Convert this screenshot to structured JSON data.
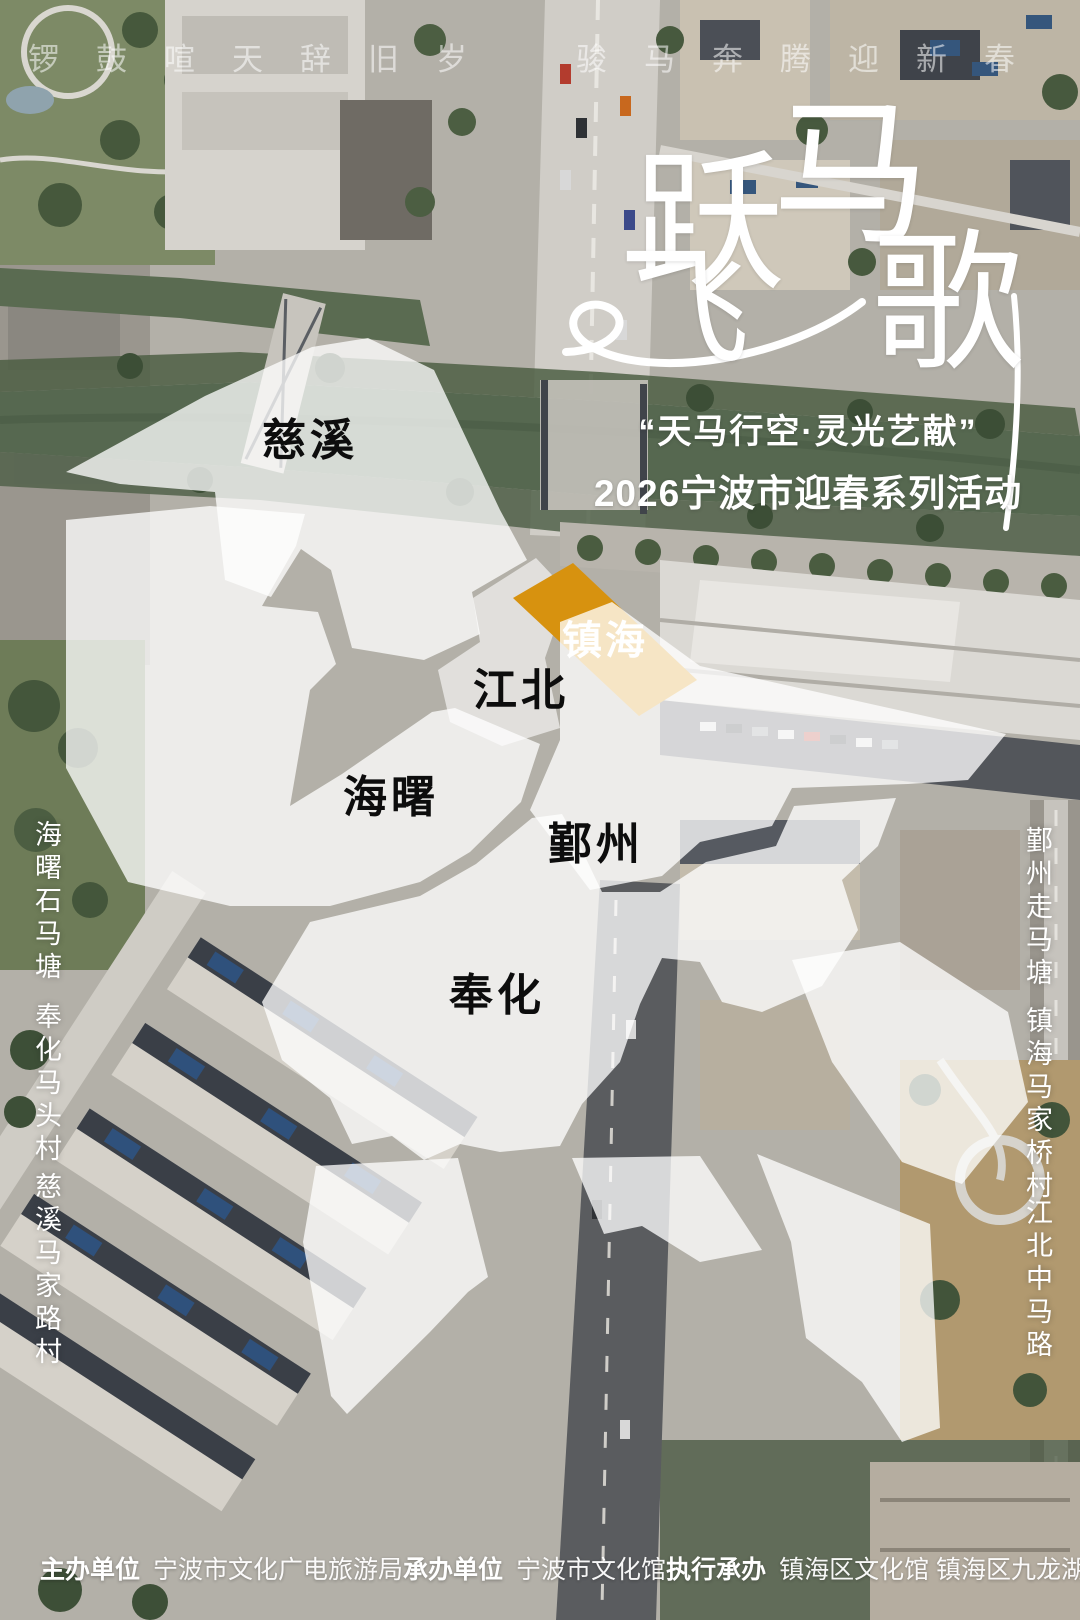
{
  "top_banner": {
    "left_phrase": "锣鼓喧天辞旧岁",
    "right_phrase": "骏马奔腾迎新春"
  },
  "title": {
    "text": "跃马飞歌",
    "chars": [
      "跃",
      "马",
      "飞",
      "歌"
    ]
  },
  "subtitle": {
    "line1": "“天马行空·灵光艺献”",
    "line2": "2026宁波市迎春系列活动"
  },
  "regions": [
    {
      "id": "cixi",
      "label": "慈溪",
      "highlighted": false
    },
    {
      "id": "zhenhai",
      "label": "镇海",
      "highlighted": true
    },
    {
      "id": "jiangbei",
      "label": "江北",
      "highlighted": false
    },
    {
      "id": "haishu",
      "label": "海曙",
      "highlighted": false
    },
    {
      "id": "yinzhou",
      "label": "鄞州",
      "highlighted": false
    },
    {
      "id": "fenghua",
      "label": "奉化",
      "highlighted": false
    }
  ],
  "side_labels": {
    "left": [
      "海曙石马塘",
      "奉化马头村",
      "慈溪马家路村"
    ],
    "right": [
      "鄞州走马塘",
      "镇海马家桥村",
      "江北中马路"
    ]
  },
  "credits": [
    {
      "label": "主办单位",
      "value": "宁波市文化广电旅游局"
    },
    {
      "label": "承办单位",
      "value": "宁波市文化馆"
    },
    {
      "label": "执行承办",
      "value": "镇海区文化馆 镇海区九龙湖镇文化站"
    }
  ],
  "colors": {
    "highlight": "#D7920F",
    "label_dark": "#0d0d0d",
    "text_white": "#ffffff",
    "overlay_white": "rgba(255,255,255,0.76)"
  }
}
